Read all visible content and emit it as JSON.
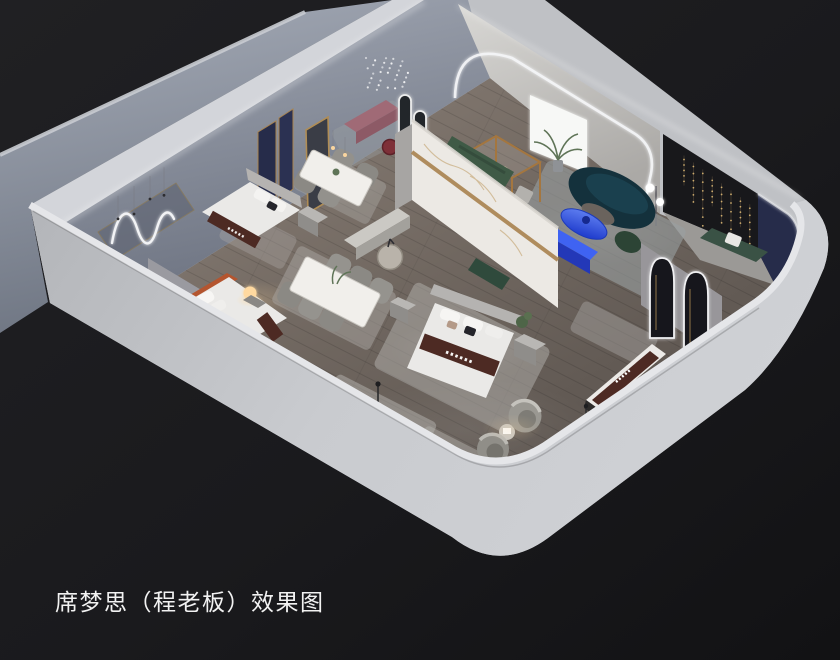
{
  "caption": {
    "text": "席梦思（程老板）效果图"
  },
  "scene": {
    "type": "3d-interior-rendering",
    "subject": "simmons-mattress-showroom-dollhouse-view",
    "colors": {
      "background": "#1b1b1e",
      "backgroundDark": "#121214",
      "wallExterior": "#c4c6ca",
      "wallTop": "#e5e6e9",
      "wallBackdrop": "#8f96a4",
      "wallInterior": "#8e94a2",
      "floorLight": "#8d8279",
      "floorDark": "#5a534d",
      "rug": "#b2b0ac",
      "marble": "#ece9e4",
      "gold": "#a9834f",
      "navyPanel": "#262c4a",
      "accentBlue": "#2f55e6",
      "tealSofa": "#14313c",
      "greenSofa": "#3f5a46",
      "mauveBench": "#a06a76",
      "terracotta": "#b4552f",
      "mattressBrown": "#4d2a23",
      "bedWhite": "#eae9e7",
      "charcoalWall": "#18181b",
      "warmGlow": "#ffd9a0",
      "ledWhite": "#f5f6f8",
      "captionText": "#f2f2f2"
    },
    "elements": [
      "display-bed-gray-headboard",
      "display-bed-terracotta-headboard",
      "display-bed-center-marble-wall",
      "dining-set-4-chairs",
      "dining-set-6-chairs",
      "green-sectional-sofa",
      "teal-curved-sofa",
      "blue-oval-coffee-table",
      "blue-media-console",
      "mauve-bench",
      "barrel-armchairs",
      "mattress-display-stands",
      "arched-led-mirrors",
      "pill-led-mirrors",
      "neon-squiggle-wall-light",
      "crystal-pendant-cluster",
      "string-light-curtains",
      "glowing-orb-lamp",
      "marble-feature-wall",
      "navy-fabric-panels",
      "wood-glass-booth",
      "area-rugs",
      "potted-plants"
    ]
  }
}
